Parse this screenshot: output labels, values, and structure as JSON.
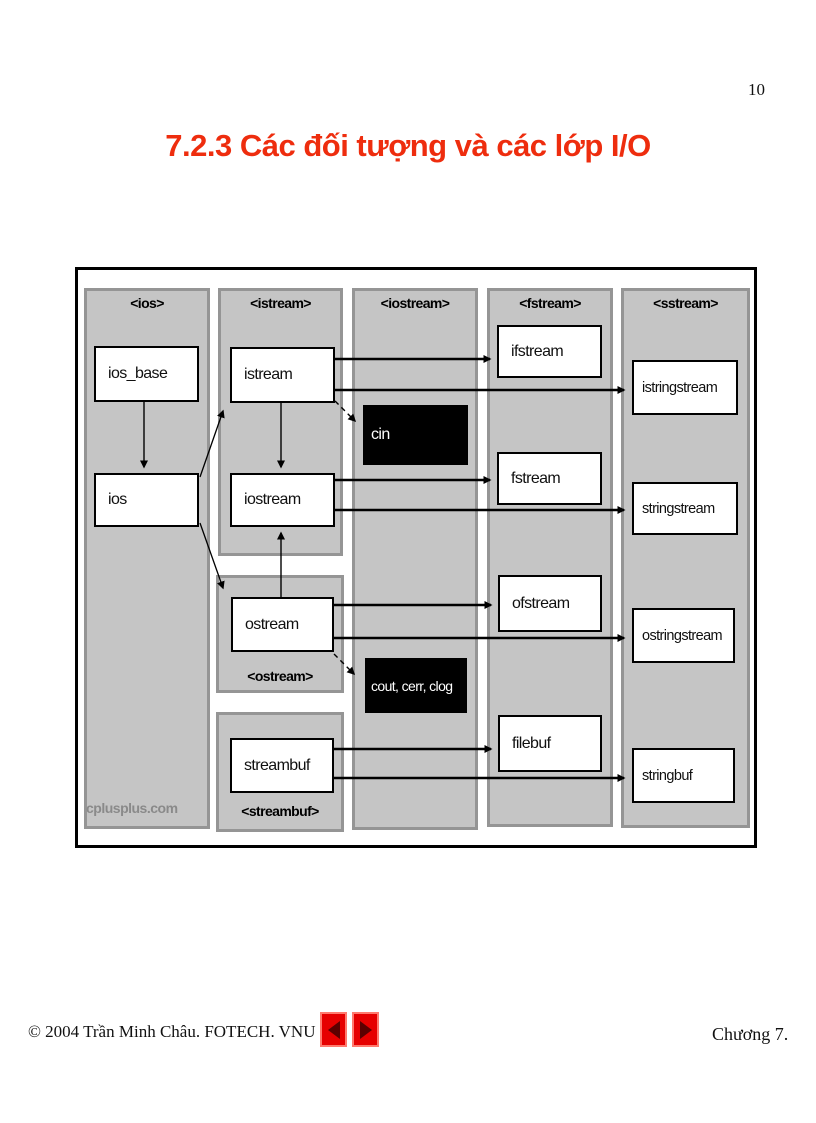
{
  "page": {
    "number": "10",
    "title": "7.2.3 Các đối tượng và các lớp I/O"
  },
  "colors": {
    "title_red": "#ee2d0e",
    "panel_gray": "#c5c5c5",
    "panel_border_gray": "#959595",
    "object_box_black": "#000000",
    "nav_button_red": "#e60000",
    "watermark_gray": "#8a8a8a"
  },
  "diagram": {
    "watermark": "cplusplus.com",
    "headers": {
      "ios": "<ios>",
      "istream": "<istream>",
      "iostream": "<iostream>",
      "fstream": "<fstream>",
      "sstream": "<sstream>"
    },
    "sublabels": {
      "ostream": "<ostream>",
      "streambuf": "<streambuf>"
    },
    "classes": {
      "ios_base": "ios_base",
      "ios": "ios",
      "istream": "istream",
      "iostream": "iostream",
      "ostream": "ostream",
      "streambuf": "streambuf",
      "ifstream": "ifstream",
      "fstream": "fstream",
      "ofstream": "ofstream",
      "filebuf": "filebuf",
      "istringstream": "istringstream",
      "stringstream": "stringstream",
      "ostringstream": "ostringstream",
      "stringbuf": "stringbuf"
    },
    "objects": {
      "cin": "cin",
      "cout_cerr_clog": "cout, cerr, clog"
    },
    "edges": [
      {
        "from": "ios_base",
        "to": "ios",
        "style": "solid"
      },
      {
        "from": "ios",
        "to": "istream",
        "style": "solid"
      },
      {
        "from": "ios",
        "to": "ostream",
        "style": "solid"
      },
      {
        "from": "istream",
        "to": "iostream",
        "style": "solid"
      },
      {
        "from": "ostream",
        "to": "iostream",
        "style": "solid"
      },
      {
        "from": "istream",
        "to": "cin",
        "style": "dashed"
      },
      {
        "from": "ostream",
        "to": "cout_cerr_clog",
        "style": "dashed"
      },
      {
        "from": "istream",
        "to": "ifstream",
        "style": "solid"
      },
      {
        "from": "istream",
        "to": "istringstream",
        "style": "solid"
      },
      {
        "from": "iostream",
        "to": "fstream",
        "style": "solid"
      },
      {
        "from": "iostream",
        "to": "stringstream",
        "style": "solid"
      },
      {
        "from": "ostream",
        "to": "ofstream",
        "style": "solid"
      },
      {
        "from": "ostream",
        "to": "ostringstream",
        "style": "solid"
      },
      {
        "from": "streambuf",
        "to": "filebuf",
        "style": "solid"
      },
      {
        "from": "streambuf",
        "to": "stringbuf",
        "style": "solid"
      }
    ]
  },
  "footer": {
    "copyright": "© 2004 Trần Minh Châu. FOTECH. VNU",
    "chapter": "Chương 7."
  }
}
